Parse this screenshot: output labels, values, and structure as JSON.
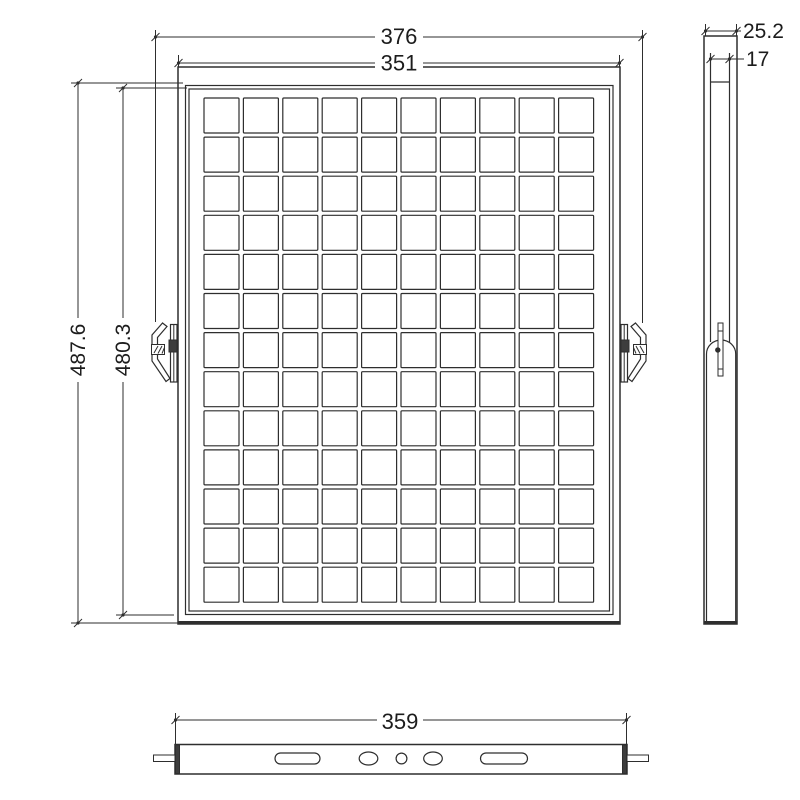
{
  "drawing": {
    "background_color": "#ffffff",
    "line_color": "#2e2e2e",
    "front_view": {
      "dim_overall_width": "376",
      "dim_frame_width": "351",
      "dim_overall_height": "487.6",
      "dim_inner_height": "480.3",
      "grid": {
        "rows": 13,
        "cols": 10
      }
    },
    "side_view": {
      "dim_depth": "25.2",
      "dim_inner_depth": "17"
    },
    "bottom_view": {
      "dim_width": "359"
    }
  }
}
